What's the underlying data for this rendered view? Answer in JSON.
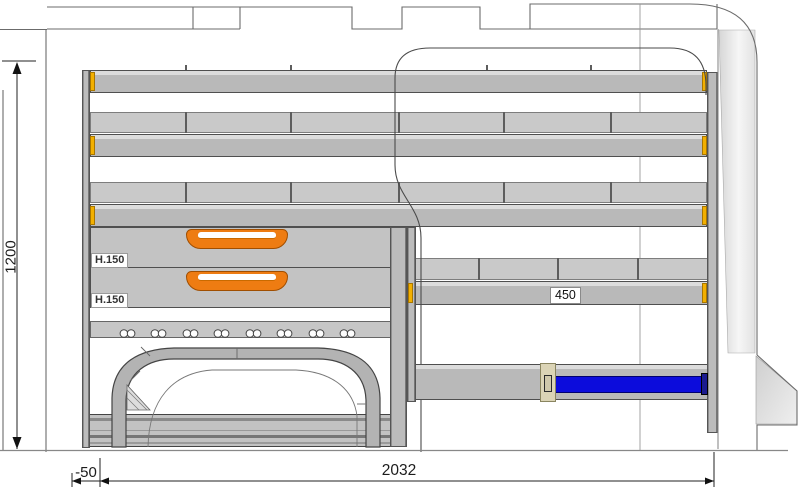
{
  "drawing": {
    "kind": "van-racking-side-elevation",
    "dimensions": {
      "total_height": "1200",
      "total_length": "2032",
      "rear_offset": "-50",
      "shelf_width": "450"
    },
    "drawers": [
      {
        "label": "H.150"
      },
      {
        "label": "H.150"
      }
    ],
    "lashing_slot_count": 8,
    "colors": {
      "shelf_gray": "#b9b9b9",
      "strip_gray": "#c9c9c9",
      "end_cap_yellow": "#f3b000",
      "drawer_handle_orange": "#ee7c12",
      "clamp_bar_blue": "#0c0cdc",
      "outline_gray": "#666666"
    }
  }
}
